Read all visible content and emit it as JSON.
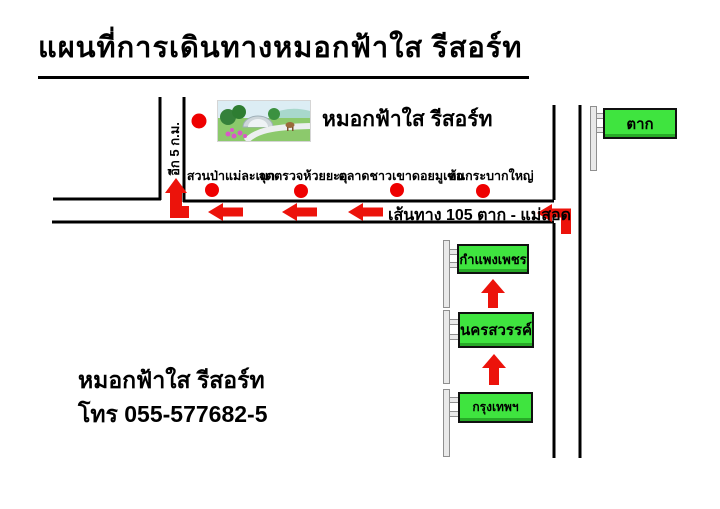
{
  "title": "แผนที่การเดินทางหมอกฟ้าใส รีสอร์ท",
  "map": {
    "resort": {
      "name": "หมอกฟ้าใส รีสอร์ท",
      "distance_label": "อีก 5 ก.ม."
    },
    "route_label": "เส้นทาง 105 ตาก - แม่สอด",
    "pois": [
      "สวนป่าแม่ละเมา",
      "จุดตรวจห้วยยะอุ",
      "ตลาดชาวเขาดอยมูเซอ",
      "ต้นกระบากใหญ่"
    ],
    "signs": {
      "tak": "ตาก",
      "kamphaeng_phet": "กำแพงเพชร",
      "nakhon_sawan": "นครสวรรค์",
      "bangkok": "กรุงเทพฯ"
    },
    "colors": {
      "sign_green": "#3fe43f",
      "arrow_red": "#ec130b",
      "road_black": "#000000"
    }
  },
  "footer": {
    "resort_name": "หมอกฟ้าใส รีสอร์ท",
    "phone": "โทร 055-577682-5"
  }
}
